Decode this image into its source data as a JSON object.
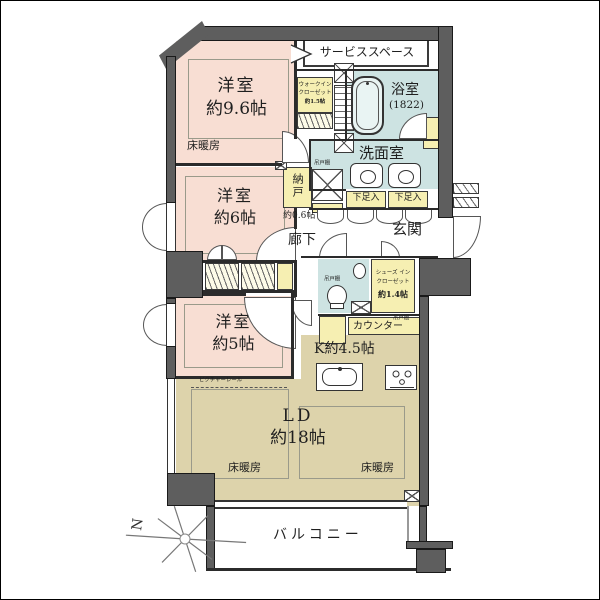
{
  "plan": {
    "labels": {
      "service_space": "サービススペース",
      "room1_name": "洋室",
      "room1_size": "約9.6帖",
      "floor_heating": "床暖房",
      "wic_line1": "ウォークイン",
      "wic_line2": "クローゼット",
      "wic_line3": "約1.5帖",
      "bathroom_name": "浴室",
      "bathroom_size": "(1822)",
      "washroom": "洗面室",
      "hanging_cupboard": "吊戸棚",
      "shoe_cabinet": "下足入",
      "entrance": "玄関",
      "storage_name": "納戸",
      "storage_size": "約0.6帖",
      "corridor": "廊下",
      "room2_name": "洋室",
      "room2_size": "約6帖",
      "room3_name": "洋室",
      "room3_size": "約5帖",
      "sic_line1": "シューズ イン",
      "sic_line2": "クローゼット",
      "sic_line3": "約1.4帖",
      "counter": "カウンター",
      "kitchen": "K約4.5帖",
      "ld_name": "LD",
      "ld_size": "約18帖",
      "picture_rail": "ピクチャーレール",
      "balcony": "バルコニー",
      "compass_north": "N"
    },
    "colors": {
      "room_pink": "#f8ded3",
      "living_beige": "#ddd3ab",
      "wet_blue": "#cde3e2",
      "storage_yellow": "#f6efb2",
      "wall_gray": "#5e5e5e"
    }
  }
}
